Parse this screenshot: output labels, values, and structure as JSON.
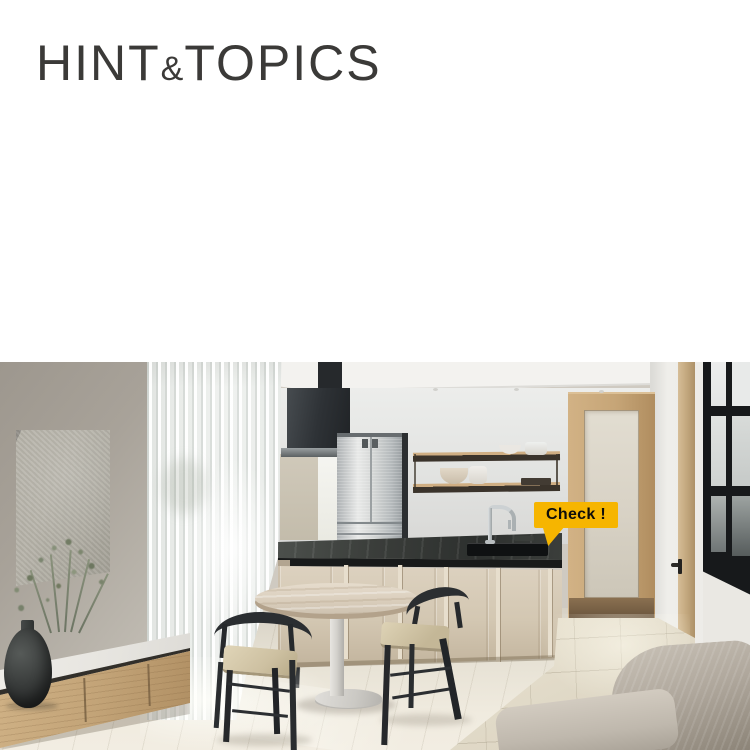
{
  "page": {
    "background": "#ffffff"
  },
  "header": {
    "logo_part1": "HINT",
    "logo_amp": "&",
    "logo_part2": "TOPICS",
    "logo_color": "#3b3a38"
  },
  "hero": {
    "callout_label": "Check !",
    "callout_bg": "#f6b500",
    "callout_text_color": "#0e0d0b",
    "scene": "kitchen-dining-living interior photo with yellow callout pointing at kitchen faucet"
  },
  "palette": {
    "accent_yellow": "#f6b500",
    "counter_black": "#2d302e",
    "cabinet_beige": "#d3c7b2",
    "wood_oak": "#c3a478",
    "wall_greige": "#a8a299",
    "sofa_greige": "#b0a89d"
  }
}
